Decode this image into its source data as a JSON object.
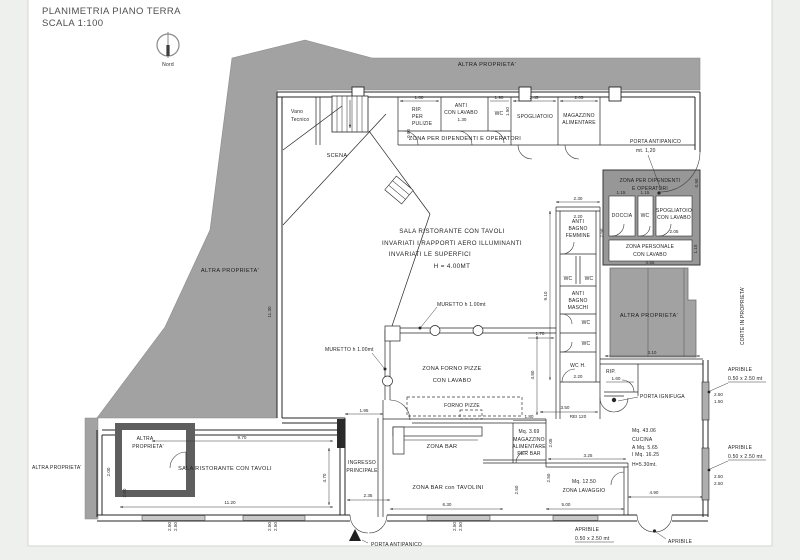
{
  "title": {
    "line1": "PLANIMETRIA PIANO TERRA",
    "line2": "SCALA 1:100"
  },
  "compass": {
    "label": "Nord"
  },
  "colors": {
    "area_gray": "#a2a2a2",
    "block_gray": "#979797",
    "dark_gray": "#5e5e5e",
    "line": "#262626",
    "paper": "#ffffff"
  },
  "areas": {
    "top": "ALTRA  PROPRIETA'",
    "left": "ALTRA  PROPRIETA'",
    "left_small": "ALTRA  PROPRIETA'",
    "box_small_l1": "ALTRA",
    "box_small_l2": "PROPRIETA'",
    "right": "ALTRA  PROPRIETA'",
    "corte": "CORTE IN PROPRIETA'"
  },
  "rooms": {
    "vano_l1": "Vano",
    "vano_l2": "Tecnico",
    "scena": "SCENA",
    "rip_l1": "RIP.",
    "rip_l2": "PER",
    "rip_l3": "PULIZIE",
    "anti_l1": "ANTI",
    "anti_l2": "CON LAVABO",
    "wc_top": "WC",
    "spogliatoio": "SPOGLIATOIO",
    "mag_l1": "MAGAZZINO",
    "mag_l2": "ALIMENTARE",
    "corridoio": "ZONA PER DIPENDENTI E OPERATORI",
    "blocco_l1": "ZONA PER DIPENDENTI",
    "blocco_l2": "E OPERATORI",
    "doccia": "DOCCIA",
    "wc_blocco": "WC",
    "spog2_l1": "SPOGLIATOIO",
    "spog2_l2": "CON LAVABO",
    "personale_l1": "ZONA PERSONALE",
    "personale_l2": "CON LAVABO",
    "abf_l1": "ANTI",
    "abf_l2": "BAGNO",
    "abf_l3": "FEMMINE",
    "wc_f1": "WC",
    "wc_f2": "WC",
    "abm_l1": "ANTI",
    "abm_l2": "BAGNO",
    "abm_l3": "MASCHI",
    "wc_m1": "WC",
    "wc_m2": "WC",
    "wc_h": "WC  H.",
    "sala_l1": "SALA RISTORANTE CON TAVOLI",
    "sala_l2": "INVARIATI I RAPPORTI AERO ILLUMINANTI",
    "sala_l3": "INVARIATI LE SUPERFICI",
    "sala_l4": "H = 4.00MT",
    "forno_l1": "ZONA FORNO PIZZE",
    "forno_l2": "CON LAVABO",
    "forno_pizze": "FORNO PIZZE",
    "zona_bar": "ZONA BAR",
    "bar_tavolini": "ZONA BAR con  TAVOLINI",
    "magbar_l1": "Mq. 3.69",
    "magbar_l2": "MAGAZZINO",
    "magbar_l3": "ALIMENTARE",
    "magbar_l4": "PER BAR",
    "lav_l1": "Mq. 12.50",
    "lav_l2": "ZONA LAVAGGIO",
    "cucina_l1": "Mq. 43.06",
    "cucina_l2": "CUCINA",
    "cucina_l3": "A  Mq. 5.65",
    "cucina_l4": "I  Mq. 16.25",
    "cucina_l5": "H=5.30mt.",
    "rip2": "RIP.",
    "sala_sx": "SALA RISTORANTE CON TAVOLI",
    "ingresso_l1": "INGRESSO",
    "ingresso_l2": "PRINCIPALE"
  },
  "annotations": {
    "muretto1": "MURETTO h 1.00mt",
    "muretto2": "MURETTO h 1.00mt",
    "porta_antipanico_dx_l1": "PORTA ANTIPANICO",
    "porta_antipanico_dx_l2": "mt. 1,20",
    "porta_ignifuga": "PORTA IGNIFUGA",
    "rei": "REI 120",
    "porta_antipanico_sud": "PORTA ANTIPANICO",
    "apribile1_l1": "APRIBILE",
    "apribile1_l2": "0.50 x 2.50 mt",
    "apribile2_l1": "APRIBILE",
    "apribile2_l2": "0.50 x 2.50 mt",
    "apribile3_l1": "APRIBILE",
    "apribile3_l2": "0.50 x 2.50 mt",
    "apribile4": "APRIBILE"
  },
  "dims": {
    "rip_w": "1.80",
    "anti_w": "1.30",
    "wc_w": "1.90",
    "corr_h": "0.90",
    "spog_h": "1.50",
    "spog_w": "2.45",
    "mag_w": "2.05",
    "bagni_w1": "2.30",
    "bagni_w2": "2.20",
    "bagni_h": "9.10",
    "abf_h": "2.50",
    "disimp": "1.70",
    "wch_w": "2.20",
    "doccia_w": "1.15",
    "wcb_w": "1.15",
    "spog2_w": "2.05",
    "pers_w": "4.55",
    "pers_h": "1.15",
    "blocco_h": "0.90",
    "muro_sx": "11.30",
    "ingresso_top": "1.95",
    "ingresso_porta": "2.35",
    "sala_top": "9.70",
    "sala_bottom": "11.20",
    "sala_dx": "4.70",
    "sala_sx_h": "2.00",
    "box_h": "2.00",
    "tavolini_w": "6.30",
    "tav_h": "2.50",
    "forno_h": "4.80",
    "magbar_w": "1.80",
    "magbar_h": "2.05",
    "rei_w": "3.50",
    "lav_top": "3.25",
    "lav_sx": "2.50",
    "lav_bottom": "5.00",
    "cucina_top": "3.10",
    "rip2_w": "1.60",
    "cucina_bottom": "4.90",
    "w1a": "2.50",
    "w1b": "2.50",
    "w2a": "2.50",
    "w2b": "2.50",
    "w3a": "2.50",
    "w3b": "2.50",
    "dx1a": "2.50",
    "dx1b": "1.50",
    "dx2a": "2.50",
    "dx2b": "2.50"
  }
}
